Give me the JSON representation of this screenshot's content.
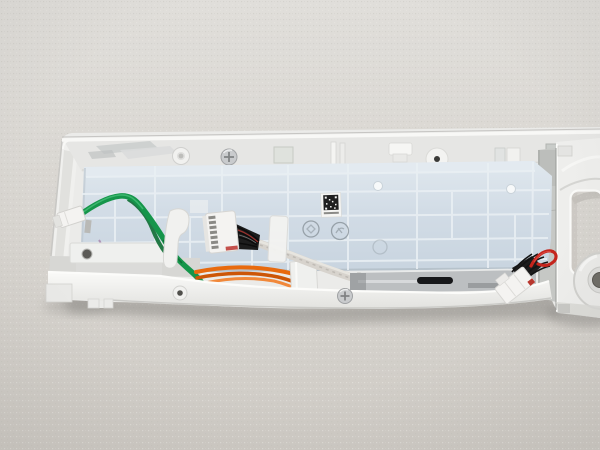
{
  "scene": {
    "type": "photograph",
    "subject": "rear side of a white appliance control panel with circuit-board cover and wiring",
    "setting": "panel lying on a light grey textured fabric surface"
  },
  "colors": {
    "fabric": "#d6d3ce",
    "fabric_light": "#e0deda",
    "fabric_dark": "#cecbc5",
    "panel_white": "#ebebe9",
    "panel_bright": "#f8f8f6",
    "panel_shade": "#d9d9d6",
    "cover_blue": "#cfdae4",
    "cover_blue_light": "#e3eaf0",
    "cover_grid": "#eaf0f4",
    "wire_green": "#15954a",
    "wire_green_dark": "#0d6d33",
    "wire_orange": "#e86a0e",
    "wire_orange_dark": "#cc5607",
    "wire_red": "#c4251d",
    "wire_black": "#1d1d1d",
    "cable_grey": "#d7d3cd",
    "cable_grey_dark": "#b7b3ac",
    "connector_white": "#f4f3f1",
    "connector_edge": "#d6d5d2",
    "metal": "#bcbfc1",
    "metal_dark": "#17181a",
    "screw_silver": "#c9cbcd",
    "grey_wall": "#c6c8c5",
    "label_white": "#f5f5f3",
    "qr_black": "#1f1f1f",
    "emboss_grey": "#8e989f"
  },
  "objects": {
    "panel": "control-panel-rear",
    "cover": "pcb-cover",
    "green_wire": "green-ground-wire",
    "harness": "multi-pin-harness-connector",
    "grey_cable": "sleeved-display-cable",
    "orange_wires": "orange-wire-bundle",
    "right_connector": "power-connector-red-black",
    "qr_label": "qr-code-sticker",
    "screw": "mounting-screw",
    "opening": "knob-display-opening"
  }
}
